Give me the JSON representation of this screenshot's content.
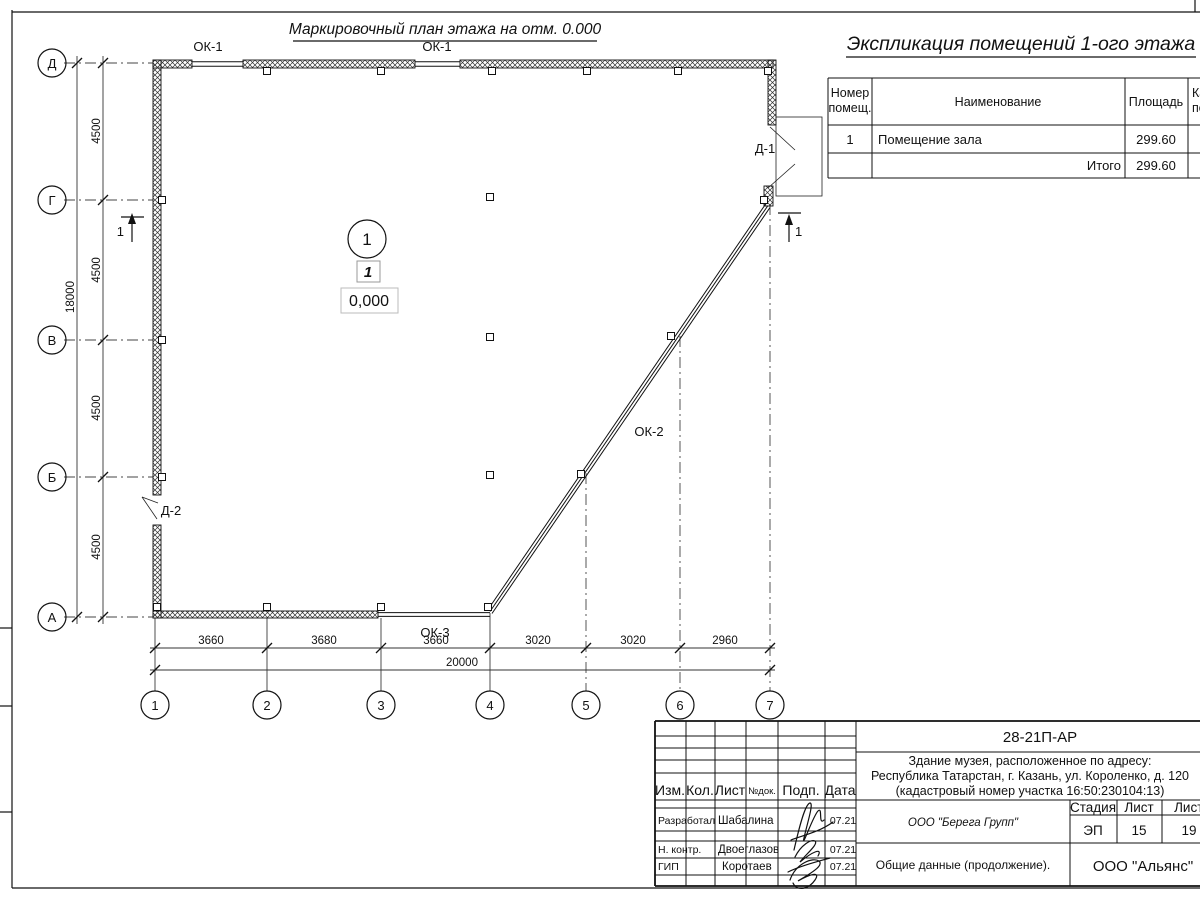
{
  "plan": {
    "title": "Маркировочный план этажа на отм. 0.000",
    "labels": {
      "ok1_a": "ОК-1",
      "ok1_b": "ОК-1",
      "ok2": "ОК-2",
      "ok3": "ОК-3",
      "d1": "Д-1",
      "d2": "Д-2"
    },
    "room_marker": {
      "number": "1",
      "mark": "1",
      "elevation": "0,000"
    },
    "section_left": "1",
    "section_right": "1",
    "axes_rows": [
      "Д",
      "Г",
      "В",
      "Б",
      "А"
    ],
    "axes_cols": [
      "1",
      "2",
      "3",
      "4",
      "5",
      "6",
      "7"
    ],
    "dims_vertical": [
      "4500",
      "4500",
      "4500",
      "4500"
    ],
    "dim_vertical_total": "18000",
    "dims_horizontal": [
      "3660",
      "3680",
      "3660",
      "3020",
      "3020",
      "2960"
    ],
    "dim_horizontal_total": "20000"
  },
  "explication": {
    "title": "Экспликация помещений 1-ого этажа",
    "headers": {
      "number_line1": "Номер",
      "number_line2": "помещ.",
      "name": "Наименование",
      "area": "Площадь",
      "cut_line1": "Ка",
      "cut_line2": "по"
    },
    "row": {
      "number": "1",
      "name": "Помещение зала",
      "area": "299.60"
    },
    "total_label": "Итого",
    "total_area": "299.60"
  },
  "title_block": {
    "doc_number": "28-21П-АР",
    "address_line1": "Здание музея, расположенное по адресу:",
    "address_line2": "Республика Татарстан, г. Казань, ул. Короленко, д. 120",
    "address_line3": "(кадастровый номер участка 16:50:230104:13)",
    "col_izm": "Изм.",
    "col_kol": "Кол.",
    "col_list": "Лист",
    "col_doc": "№док.",
    "col_podp": "Подп.",
    "col_data": "Дата",
    "row1_role": "Разработал",
    "row1_name": "Шабалина",
    "row1_date": "07.21",
    "row2_role": "Н. контр.",
    "row2_name": "Двоеглазов",
    "row2_date": "07.21",
    "row3_role": "ГИП",
    "row3_name": "Коротаев",
    "row3_date": "07.21",
    "company": "ООО \"Берега Групп\"",
    "stage_label": "Стадия",
    "sheet_label": "Лист",
    "sheets_label": "Листов",
    "stage": "ЭП",
    "sheet": "15",
    "sheets": "19",
    "doc_title": "Общие данные (продолжение).",
    "contractor": "ООО \"Альянс\""
  }
}
